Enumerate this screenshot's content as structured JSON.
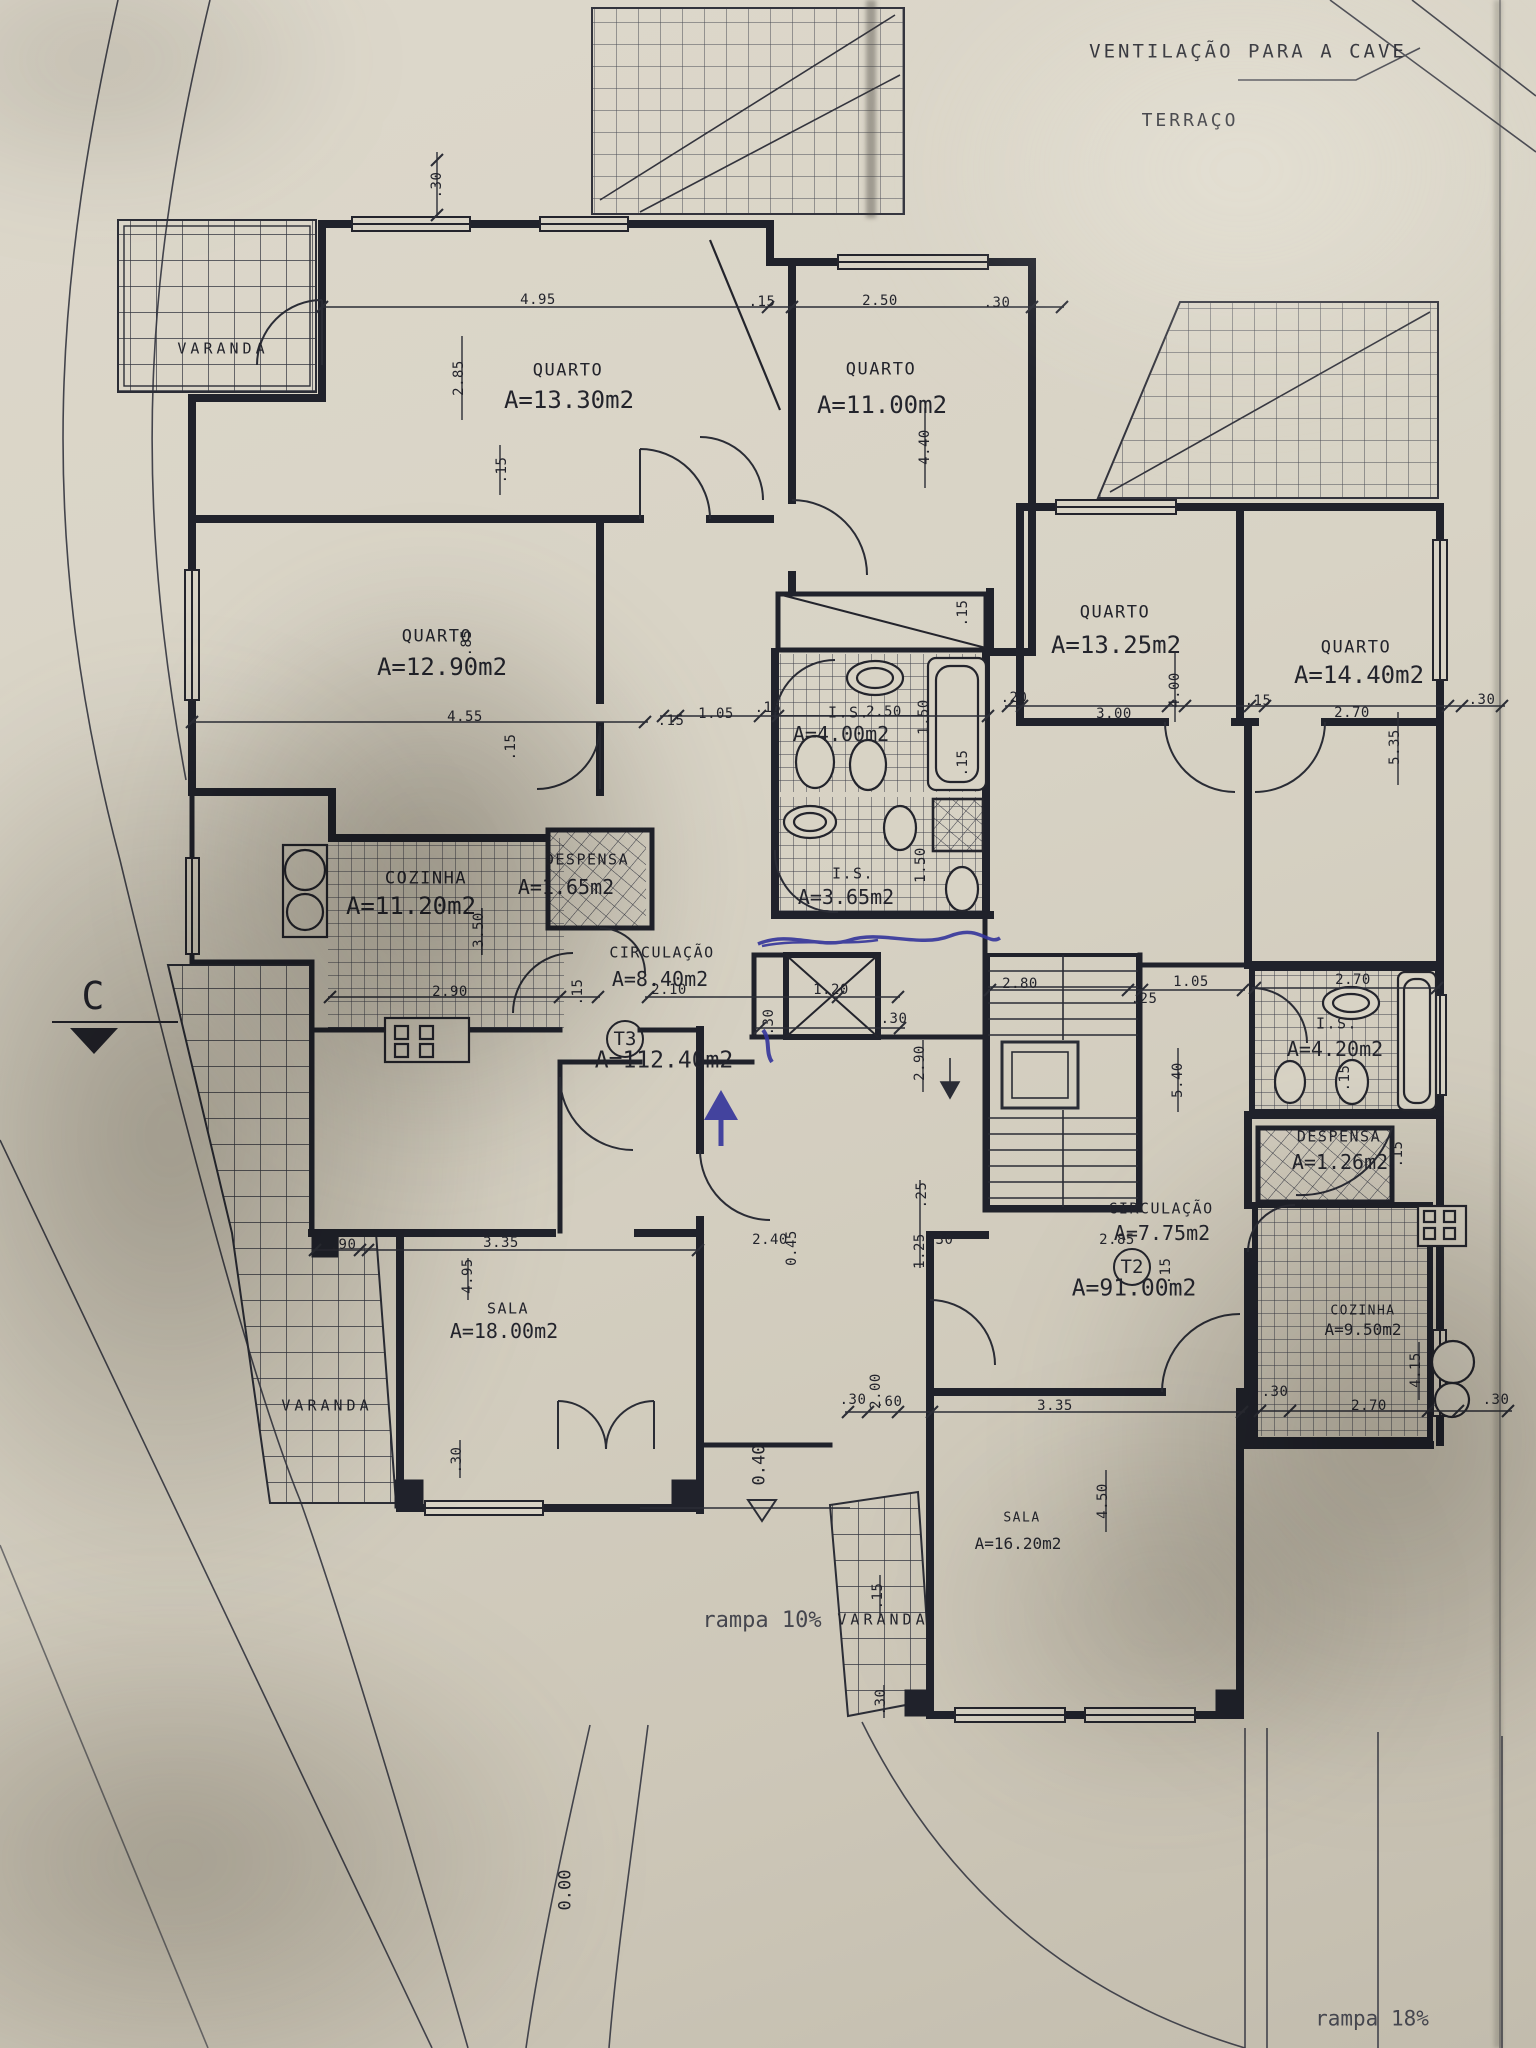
{
  "colors": {
    "paper": "#d8d3c5",
    "ink": "#23242c",
    "pen_blue": "#34349b"
  },
  "annotations": {
    "ventilacao": "VENTILAÇÃO PARA A CAVE",
    "terraco": "TERRAÇO",
    "section_marker": "C",
    "rampa_left": "rampa 10%",
    "rampa_right": "rampa 18%",
    "level_entry": "0.40",
    "level_zero": "0.00"
  },
  "units": [
    {
      "id": "t3",
      "label": "T3",
      "area": "A=112.40m2",
      "bx": 625,
      "by": 1039,
      "ax": 664,
      "ay": 1061
    },
    {
      "id": "t2",
      "label": "T2",
      "area": "A=91.00m2",
      "bx": 1132,
      "by": 1267,
      "ax": 1134,
      "ay": 1289
    }
  ],
  "rooms": [
    {
      "id": "varanda-top-left",
      "name": "VARANDA",
      "nx": 223,
      "ny": 349,
      "size": "sm",
      "vr": true
    },
    {
      "id": "quarto-13-30",
      "name": "QUARTO",
      "area": "A=13.30m2",
      "nx": 568,
      "ny": 371,
      "ax": 569,
      "ay": 400,
      "size": "lg"
    },
    {
      "id": "quarto-11-00",
      "name": "QUARTO",
      "area": "A=11.00m2",
      "nx": 881,
      "ny": 370,
      "ax": 882,
      "ay": 405,
      "size": "lg"
    },
    {
      "id": "quarto-12-90",
      "name": "QUARTO",
      "area": "A=12.90m2",
      "nx": 437,
      "ny": 637,
      "ax": 442,
      "ay": 667,
      "size": "lg"
    },
    {
      "id": "quarto-13-25",
      "name": "QUARTO",
      "area": "A=13.25m2",
      "nx": 1115,
      "ny": 613,
      "ax": 1116,
      "ay": 645,
      "size": "lg"
    },
    {
      "id": "quarto-14-40",
      "name": "QUARTO",
      "area": "A=14.40m2",
      "nx": 1356,
      "ny": 648,
      "ax": 1359,
      "ay": 675,
      "size": "lg"
    },
    {
      "id": "is-4-00",
      "name": "I.S.",
      "area": "A=4.00m2",
      "nx": 849,
      "ny": 713,
      "ax": 841,
      "ay": 734,
      "size": "md"
    },
    {
      "id": "is-3-65",
      "name": "I.S.",
      "area": "A=3.65m2",
      "nx": 853,
      "ny": 874,
      "ax": 846,
      "ay": 897,
      "size": "md"
    },
    {
      "id": "cozinha-11-20",
      "name": "COZINHA",
      "area": "A=11.20m2",
      "nx": 426,
      "ny": 879,
      "ax": 411,
      "ay": 906,
      "size": "lg"
    },
    {
      "id": "despensa-1-65",
      "name": "DESPENSA",
      "area": "A=1.65m2",
      "nx": 587,
      "ny": 860,
      "ax": 566,
      "ay": 887,
      "size": "md"
    },
    {
      "id": "circulacao-8-40",
      "name": "CIRCULAÇÃO",
      "area": "A=8.40m2",
      "nx": 662,
      "ny": 953,
      "ax": 660,
      "ay": 979,
      "size": "md"
    },
    {
      "id": "sala-18-00",
      "name": "SALA",
      "area": "A=18.00m2",
      "nx": 508,
      "ny": 1309,
      "ax": 504,
      "ay": 1331,
      "size": "md"
    },
    {
      "id": "varanda-left",
      "name": "VARANDA",
      "nx": 327,
      "ny": 1406,
      "size": "sm",
      "vr": true
    },
    {
      "id": "is-4-20",
      "name": "I.S.",
      "area": "A=4.20m2",
      "nx": 1337,
      "ny": 1024,
      "ax": 1335,
      "ay": 1049,
      "size": "md"
    },
    {
      "id": "despensa-1-26",
      "name": "DESPENSA",
      "area": "A=1.26m2",
      "nx": 1339,
      "ny": 1137,
      "ax": 1340,
      "ay": 1162,
      "size": "md"
    },
    {
      "id": "circulacao-7-75",
      "name": "CIRCULAÇÃO",
      "area": "A=7.75m2",
      "nx": 1161,
      "ny": 1209,
      "ax": 1162,
      "ay": 1233,
      "size": "md"
    },
    {
      "id": "cozinha-9-50",
      "name": "COZINHA",
      "area": "A=9.50m2",
      "nx": 1363,
      "ny": 1311,
      "ax": 1363,
      "ay": 1330,
      "size": "sm"
    },
    {
      "id": "sala-16-20",
      "name": "SALA",
      "area": "A=16.20m2",
      "nx": 1022,
      "ny": 1518,
      "ax": 1018,
      "ay": 1544,
      "size": "sm"
    },
    {
      "id": "varanda-bottom",
      "name": "VARANDA",
      "nx": 883,
      "ny": 1620,
      "size": "sm",
      "vr": true
    }
  ],
  "dimensions": [
    {
      "v": ".30",
      "x": 437,
      "y": 185,
      "r": 1
    },
    {
      "v": "4.95",
      "x": 538,
      "y": 300
    },
    {
      "v": ".15",
      "x": 762,
      "y": 302
    },
    {
      "v": "2.50",
      "x": 880,
      "y": 301
    },
    {
      "v": ".30",
      "x": 997,
      "y": 303
    },
    {
      "v": "2.85",
      "x": 459,
      "y": 378,
      "r": 1
    },
    {
      "v": "4.40",
      "x": 925,
      "y": 447,
      "r": 1
    },
    {
      "v": ".15",
      "x": 502,
      "y": 470,
      "r": 1
    },
    {
      "v": ".85",
      "x": 467,
      "y": 643,
      "r": 1
    },
    {
      "v": "4.55",
      "x": 465,
      "y": 717
    },
    {
      "v": ".15",
      "x": 511,
      "y": 747,
      "r": 1
    },
    {
      "v": ".15",
      "x": 671,
      "y": 721
    },
    {
      "v": "1.05",
      "x": 716,
      "y": 714
    },
    {
      "v": ".15",
      "x": 768,
      "y": 708
    },
    {
      "v": "2.50",
      "x": 884,
      "y": 712
    },
    {
      "v": "1.50",
      "x": 924,
      "y": 717,
      "r": 1
    },
    {
      "v": ".15",
      "x": 963,
      "y": 613,
      "r": 1
    },
    {
      "v": ".15",
      "x": 963,
      "y": 763,
      "r": 1
    },
    {
      "v": "1.50",
      "x": 921,
      "y": 865,
      "r": 1
    },
    {
      "v": ".20",
      "x": 1014,
      "y": 698
    },
    {
      "v": "3.00",
      "x": 1114,
      "y": 714
    },
    {
      "v": "4.00",
      "x": 1175,
      "y": 690,
      "r": 1
    },
    {
      "v": ".15",
      "x": 1258,
      "y": 701
    },
    {
      "v": "2.70",
      "x": 1352,
      "y": 713
    },
    {
      "v": ".30",
      "x": 1482,
      "y": 700
    },
    {
      "v": "5.35",
      "x": 1395,
      "y": 747,
      "r": 1
    },
    {
      "v": "3.50",
      "x": 479,
      "y": 930,
      "r": 1
    },
    {
      "v": "2.90",
      "x": 450,
      "y": 992
    },
    {
      "v": ".15",
      "x": 578,
      "y": 992,
      "r": 1
    },
    {
      "v": "2.10",
      "x": 669,
      "y": 990
    },
    {
      "v": "1.20",
      "x": 831,
      "y": 990
    },
    {
      "v": ".30",
      "x": 769,
      "y": 1022,
      "r": 1
    },
    {
      "v": ".30",
      "x": 894,
      "y": 1019
    },
    {
      "v": "2.80",
      "x": 1020,
      "y": 984
    },
    {
      "v": ".25",
      "x": 1144,
      "y": 999
    },
    {
      "v": "1.05",
      "x": 1191,
      "y": 982
    },
    {
      "v": "2.70",
      "x": 1353,
      "y": 980
    },
    {
      "v": "2.90",
      "x": 920,
      "y": 1063,
      "r": 1
    },
    {
      "v": "5.40",
      "x": 1178,
      "y": 1080,
      "r": 1
    },
    {
      "v": ".15",
      "x": 1345,
      "y": 1078,
      "r": 1
    },
    {
      "v": ".25",
      "x": 922,
      "y": 1195,
      "r": 1
    },
    {
      "v": "1.25",
      "x": 920,
      "y": 1251,
      "r": 1
    },
    {
      "v": ".30",
      "x": 940,
      "y": 1240
    },
    {
      "v": "2.85",
      "x": 1117,
      "y": 1240
    },
    {
      "v": ".15",
      "x": 1166,
      "y": 1271,
      "r": 1
    },
    {
      "v": ".15",
      "x": 1398,
      "y": 1154,
      "r": 1
    },
    {
      "v": ".90",
      "x": 343,
      "y": 1245
    },
    {
      "v": "3.35",
      "x": 501,
      "y": 1243
    },
    {
      "v": "4.95",
      "x": 468,
      "y": 1276,
      "r": 1
    },
    {
      "v": ".30",
      "x": 457,
      "y": 1460,
      "r": 1
    },
    {
      "v": "2.40",
      "x": 770,
      "y": 1240
    },
    {
      "v": "0.45",
      "x": 792,
      "y": 1248,
      "r": 1
    },
    {
      "v": ".30",
      "x": 853,
      "y": 1400
    },
    {
      "v": "2.00",
      "x": 876,
      "y": 1391,
      "r": 1
    },
    {
      "v": ".60",
      "x": 889,
      "y": 1402
    },
    {
      "v": "3.35",
      "x": 1055,
      "y": 1406
    },
    {
      "v": "4.50",
      "x": 1103,
      "y": 1501,
      "r": 1
    },
    {
      "v": ".15",
      "x": 878,
      "y": 1596,
      "r": 1
    },
    {
      "v": ".30",
      "x": 881,
      "y": 1702,
      "r": 1
    },
    {
      "v": "4.15",
      "x": 1416,
      "y": 1370,
      "r": 1
    },
    {
      "v": "2.70",
      "x": 1369,
      "y": 1406
    },
    {
      "v": ".30",
      "x": 1275,
      "y": 1392
    },
    {
      "v": ".30",
      "x": 1496,
      "y": 1400
    }
  ]
}
